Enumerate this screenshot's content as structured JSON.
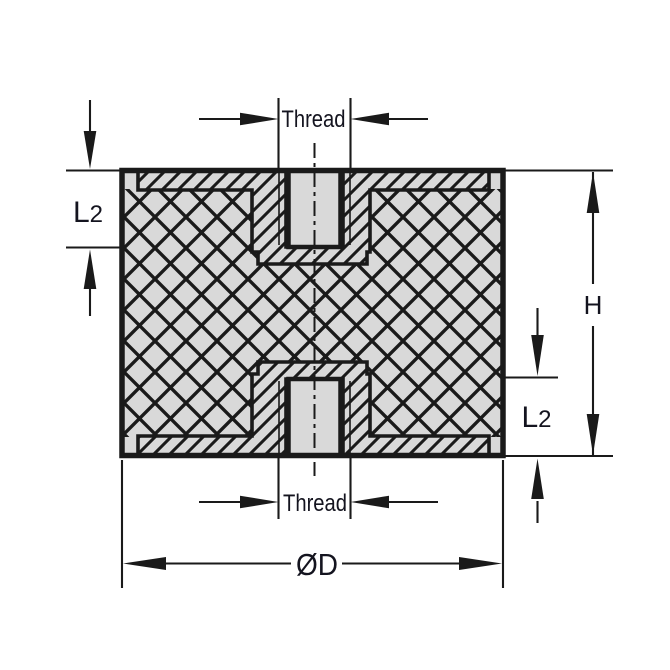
{
  "diagram": {
    "description": "cross-section technical drawing of cylindrical rubber mount with two female threaded inserts",
    "labels": {
      "thread_top": "Thread",
      "thread_bottom": "Thread",
      "l2_left": {
        "main": "L",
        "sub": "2"
      },
      "l2_right": {
        "main": "L",
        "sub": "2"
      },
      "height": "H",
      "diameter": "ØD"
    },
    "colors": {
      "background": "#ffffff",
      "line": "#1a1a1a",
      "fill": "#d9d9d9",
      "text": "#14141f"
    }
  }
}
